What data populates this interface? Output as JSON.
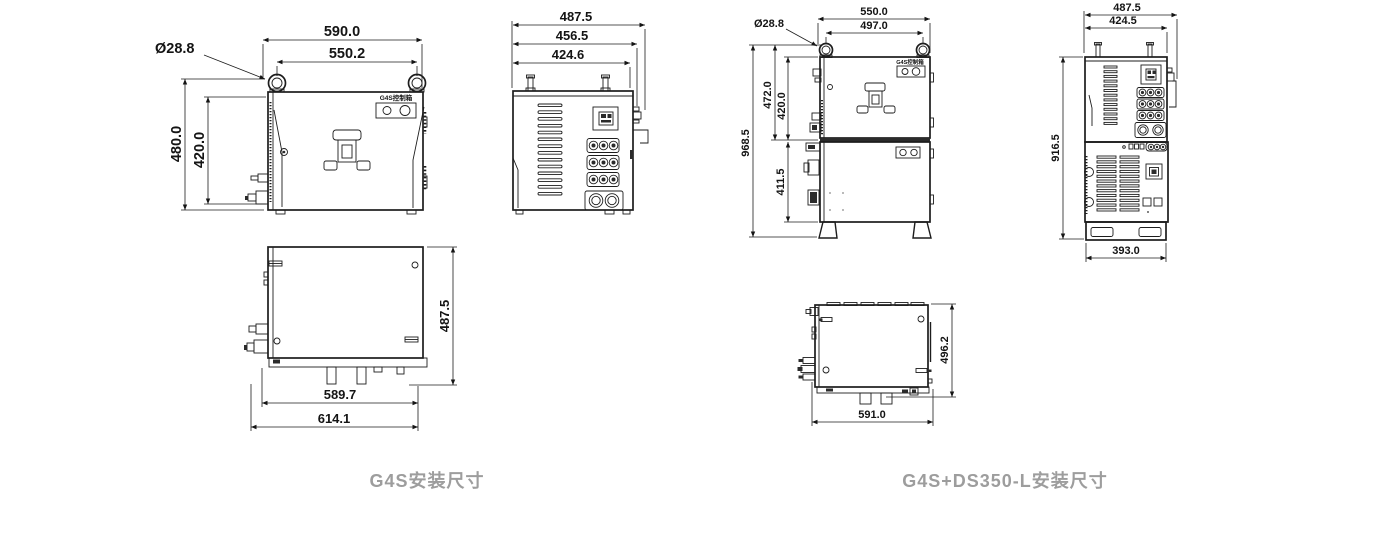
{
  "colors": {
    "line": "#1d1d1d",
    "caption_gray": "#9d9d9d",
    "background": "#ffffff",
    "connector_fill": "#2b2b2b"
  },
  "g4s": {
    "caption": "G4S安装尺寸",
    "panel_label": "G4S控制箱",
    "front": {
      "eyebolt_dia": "Ø28.8",
      "w_outer": "590.0",
      "w_bolts": "550.2",
      "h_outer": "480.0",
      "h_body": "420.0"
    },
    "side": {
      "d_outer": "487.5",
      "d_mid": "456.5",
      "d_body": "424.6"
    },
    "top": {
      "depth": "487.5",
      "w_body": "589.7",
      "w_outer": "614.1"
    }
  },
  "g4s_ds350": {
    "caption": "G4S+DS350-L安装尺寸",
    "panel_label": "G4S控制箱",
    "front": {
      "eyebolt_dia": "Ø28.8",
      "w_outer": "550.0",
      "w_bolts": "497.0",
      "h_upper_outer": "472.0",
      "h_upper_body": "420.0",
      "h_total": "968.5",
      "h_lower": "411.5"
    },
    "side": {
      "d_outer": "487.5",
      "d_body": "424.5",
      "h_total": "916.5",
      "w_base": "393.0"
    },
    "top": {
      "depth": "496.2",
      "width": "591.0"
    }
  }
}
